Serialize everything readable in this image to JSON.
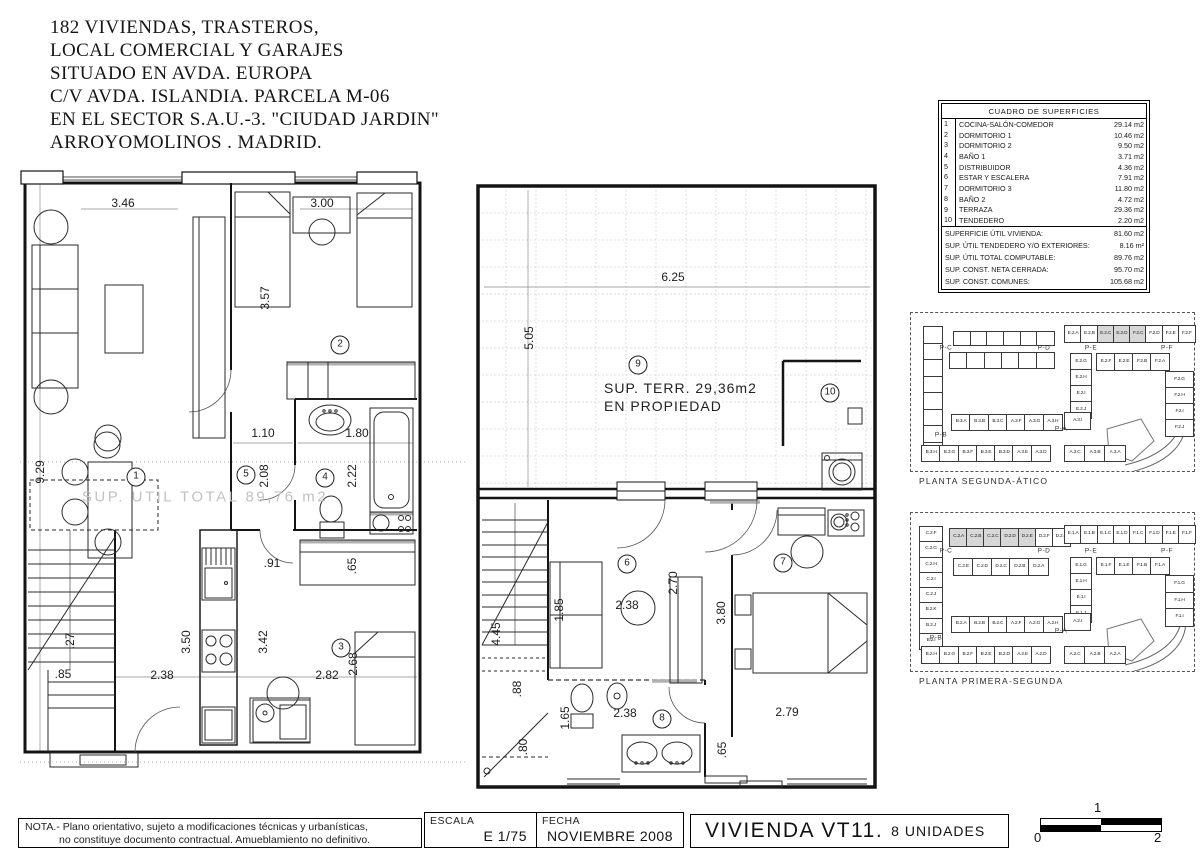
{
  "header": {
    "lines": [
      "182 VIVIENDAS, TRASTEROS,",
      "LOCAL COMERCIAL Y GARAJES",
      "SITUADO EN AVDA. EUROPA",
      "C/V  AVDA.  ISLANDIA. PARCELA M-06",
      "EN EL SECTOR S.A.U.-3. \"CIUDAD JARDIN\"",
      "ARROYOMOLINOS . MADRID."
    ]
  },
  "surface_table": {
    "title": "CUADRO DE SUPERFICIES",
    "rows": [
      {
        "num": "1",
        "name": "COCINA-SALÓN-COMEDOR",
        "area": "29.14 m2"
      },
      {
        "num": "2",
        "name": "DORMITORIO 1",
        "area": "10.46 m2"
      },
      {
        "num": "3",
        "name": "DORMITORIO 2",
        "area": "9.50 m2"
      },
      {
        "num": "4",
        "name": "BAÑO 1",
        "area": "3.71 m2"
      },
      {
        "num": "5",
        "name": "DISTRIBUIDOR",
        "area": "4.36 m2"
      },
      {
        "num": "6",
        "name": "ESTAR Y ESCALERA",
        "area": "7.91 m2"
      },
      {
        "num": "7",
        "name": "DORMITORIO 3",
        "area": "11.80 m2"
      },
      {
        "num": "8",
        "name": "BAÑO 2",
        "area": "4.72 m2"
      },
      {
        "num": "9",
        "name": "TERRAZA",
        "area": "29.36 m2"
      },
      {
        "num": "10",
        "name": "TENDEDERO",
        "area": "2.20 m2"
      }
    ],
    "summary": [
      {
        "label": "SUPERFICIE ÚTIL VIVIENDA:",
        "area": "81.60 m2"
      },
      {
        "label": "SUP. ÚTIL TENDEDERO Y/O EXTERIORES:",
        "area": "8.16 m²"
      },
      {
        "label": "SUP. ÚTIL TOTAL COMPUTABLE:",
        "area": "89.76 m2"
      },
      {
        "label": "SUP. CONST. NETA CERRADA:",
        "area": "95.70 m2"
      },
      {
        "label": "SUP. CONST. COMUNES:",
        "area": "105.68 m2"
      }
    ]
  },
  "plan_left": {
    "labels": [
      {
        "t": "3.46",
        "x": 123,
        "y": 203
      },
      {
        "t": "3.00",
        "x": 322,
        "y": 203
      },
      {
        "t": "3.57",
        "x": 265,
        "y": 298,
        "r": 1
      },
      {
        "t": "9.29",
        "x": 40,
        "y": 472,
        "r": 1
      },
      {
        "t": "1.10",
        "x": 263,
        "y": 433
      },
      {
        "t": "1.80",
        "x": 357,
        "y": 433
      },
      {
        "t": "2.08",
        "x": 264,
        "y": 476,
        "r": 1
      },
      {
        "t": "2.22",
        "x": 352,
        "y": 476,
        "r": 1
      },
      {
        "t": ".91",
        "x": 272,
        "y": 563
      },
      {
        "t": ".65",
        "x": 352,
        "y": 566,
        "r": 1
      },
      {
        "t": "3.50",
        "x": 186,
        "y": 642,
        "r": 1
      },
      {
        "t": "3.42",
        "x": 263,
        "y": 642,
        "r": 1
      },
      {
        "t": "2.38",
        "x": 162,
        "y": 675
      },
      {
        "t": "2.82",
        "x": 327,
        "y": 675
      },
      {
        "t": "2.68",
        "x": 353,
        "y": 664,
        "r": 1
      },
      {
        "t": ".85",
        "x": 63,
        "y": 674
      },
      {
        "t": ".27",
        "x": 70,
        "y": 641,
        "r": 1
      },
      {
        "t": "1",
        "x": 136,
        "y": 477,
        "c": "circ"
      },
      {
        "t": "2",
        "x": 340,
        "y": 345,
        "c": "circ"
      },
      {
        "t": "3",
        "x": 341,
        "y": 648,
        "c": "circ"
      },
      {
        "t": "4",
        "x": 325,
        "y": 478,
        "c": "circ"
      },
      {
        "t": "5",
        "x": 246,
        "y": 475,
        "c": "circ"
      },
      {
        "t": "SUP. UTIL TOTAL 89,76 m2",
        "x": 205,
        "y": 497,
        "c": "wm"
      }
    ]
  },
  "plan_center": {
    "labels": [
      {
        "t": "6.25",
        "x": 673,
        "y": 277
      },
      {
        "t": "5.05",
        "x": 529,
        "y": 338,
        "r": 1
      },
      {
        "t": "SUP. TERR. 29,36m2",
        "x": 604,
        "y": 388,
        "c": "terr"
      },
      {
        "t": "EN PROPIEDAD",
        "x": 604,
        "y": 406,
        "c": "terr"
      },
      {
        "t": "9",
        "x": 638,
        "y": 365,
        "c": "circ"
      },
      {
        "t": "10",
        "x": 830,
        "y": 393,
        "c": "circ"
      },
      {
        "t": "6",
        "x": 627,
        "y": 564,
        "c": "circ"
      },
      {
        "t": "7",
        "x": 783,
        "y": 563,
        "c": "circ"
      },
      {
        "t": "8",
        "x": 662,
        "y": 719,
        "c": "circ"
      },
      {
        "t": "4.45",
        "x": 496,
        "y": 634,
        "r": 1
      },
      {
        "t": "1.85",
        "x": 559,
        "y": 610,
        "r": 1
      },
      {
        "t": "2.38",
        "x": 627,
        "y": 605
      },
      {
        "t": "2.70",
        "x": 673,
        "y": 583,
        "r": 1
      },
      {
        "t": "3.80",
        "x": 721,
        "y": 613,
        "r": 1
      },
      {
        "t": "2.79",
        "x": 787,
        "y": 712
      },
      {
        "t": "1.65",
        "x": 565,
        "y": 718,
        "r": 1
      },
      {
        "t": "2.38",
        "x": 625,
        "y": 713
      },
      {
        "t": ".80",
        "x": 523,
        "y": 747,
        "r": 1
      },
      {
        "t": ".65",
        "x": 722,
        "y": 750,
        "r": 1
      },
      {
        "t": ".88",
        "x": 517,
        "y": 689,
        "r": 1
      }
    ]
  },
  "miniplans": [
    {
      "caption": "PLANTA SEGUNDA-ÁTICO",
      "x": 910,
      "y": 312,
      "w": 283,
      "h": 158,
      "plabels": [
        {
          "t": "P-C",
          "x": 945,
          "y": 347
        },
        {
          "t": "P-D",
          "x": 1043,
          "y": 347
        },
        {
          "t": "P-E",
          "x": 1090,
          "y": 347
        },
        {
          "t": "P-F",
          "x": 1166,
          "y": 347
        },
        {
          "t": "P-B",
          "x": 940,
          "y": 434
        },
        {
          "t": "P-A",
          "x": 1060,
          "y": 428
        }
      ],
      "groups": [
        {
          "x": 922,
          "y": 325,
          "w": 18,
          "h": 132,
          "dir": "v",
          "cells": [
            "",
            "",
            "",
            "",
            "",
            "",
            "",
            ""
          ]
        },
        {
          "x": 952,
          "y": 330,
          "w": 100,
          "h": 13,
          "dir": "h",
          "cells": [
            "",
            "",
            "",
            "",
            "",
            ""
          ]
        },
        {
          "x": 948,
          "y": 351,
          "w": 104,
          "h": 15,
          "dir": "h",
          "cells": [
            "",
            "",
            "",
            "",
            "",
            ""
          ]
        },
        {
          "x": 1063,
          "y": 324,
          "w": 130,
          "h": 16,
          "dir": "h",
          "cells": [
            "E.2.A",
            "E.2.B",
            "E.2.C",
            "E.2.D",
            "F.2.C",
            "F.2.D",
            "F.2.E",
            "F.2.F"
          ],
          "shaded": [
            2,
            3,
            4
          ]
        },
        {
          "x": 1095,
          "y": 352,
          "w": 72,
          "h": 16,
          "dir": "h",
          "cells": [
            "E.2.F",
            "E.2.E",
            "F.2.B",
            "F.2.A"
          ]
        },
        {
          "x": 1069,
          "y": 352,
          "w": 20,
          "h": 64,
          "dir": "v",
          "cells": [
            "E.2.G",
            "E.2.H",
            "E.2.I",
            "E.2.J"
          ]
        },
        {
          "x": 1164,
          "y": 370,
          "w": 27,
          "h": 64,
          "dir": "v",
          "cells": [
            "F.2.G",
            "F.2.H",
            "F.2.I",
            "F.2.J"
          ]
        },
        {
          "x": 950,
          "y": 413,
          "w": 110,
          "h": 15,
          "dir": "h",
          "cells": [
            "B.3.A",
            "B.3.B",
            "B.3.C",
            "A.3.F",
            "A.3.G",
            "A.3.H"
          ]
        },
        {
          "x": 1063,
          "y": 411,
          "w": 25,
          "h": 16,
          "dir": "h",
          "cells": [
            "A.3.I"
          ]
        },
        {
          "x": 920,
          "y": 444,
          "w": 128,
          "h": 15,
          "dir": "h",
          "cells": [
            "B.3.H",
            "B.3.G",
            "B.3.F",
            "B.3.E",
            "B.3.D",
            "A.3.E",
            "A.3.D"
          ]
        },
        {
          "x": 1063,
          "y": 444,
          "w": 60,
          "h": 15,
          "dir": "h",
          "cells": [
            "A.3.C",
            "A.3.B",
            "A.3.A"
          ]
        }
      ]
    },
    {
      "caption": "PLANTA PRIMERA-SEGUNDA",
      "x": 910,
      "y": 512,
      "w": 283,
      "h": 158,
      "plabels": [
        {
          "t": "P-C",
          "x": 945,
          "y": 550
        },
        {
          "t": "P-D",
          "x": 1043,
          "y": 550
        },
        {
          "t": "P-E",
          "x": 1090,
          "y": 550
        },
        {
          "t": "P-F",
          "x": 1166,
          "y": 550
        },
        {
          "t": "P-B",
          "x": 935,
          "y": 637
        },
        {
          "t": "P-A",
          "x": 1060,
          "y": 630
        }
      ],
      "groups": [
        {
          "x": 918,
          "y": 525,
          "w": 22,
          "h": 122,
          "dir": "v",
          "cells": [
            "C.2.F",
            "C.2.G",
            "C.2.H",
            "C.2.I",
            "C.2.J",
            "B.2.K",
            "B.2.J",
            "B.2.I"
          ]
        },
        {
          "x": 948,
          "y": 527,
          "w": 120,
          "h": 17,
          "dir": "h",
          "cells": [
            "C.2.A",
            "C.2.B",
            "C.2.C",
            "D.2.D",
            "D.2.E",
            "D.2.F",
            "D.2.G"
          ],
          "shaded": [
            0,
            1,
            2,
            3,
            4
          ]
        },
        {
          "x": 952,
          "y": 557,
          "w": 94,
          "h": 16,
          "dir": "h",
          "cells": [
            "C.2.E",
            "C.2.D",
            "D.2.C",
            "D.2.B",
            "D.2.A"
          ]
        },
        {
          "x": 1063,
          "y": 524,
          "w": 130,
          "h": 17,
          "dir": "h",
          "cells": [
            "E.1.A",
            "E.1.B",
            "E.1.C",
            "E.1.D",
            "F.1.C",
            "F.1.D",
            "F.1.E",
            "F.1.F"
          ]
        },
        {
          "x": 1095,
          "y": 556,
          "w": 72,
          "h": 16,
          "dir": "h",
          "cells": [
            "E.1.F",
            "E.1.E",
            "F.1.B",
            "F.1.A"
          ]
        },
        {
          "x": 1069,
          "y": 556,
          "w": 20,
          "h": 64,
          "dir": "v",
          "cells": [
            "E.1.G",
            "E.1.H",
            "E.1.I",
            "E.1.J"
          ]
        },
        {
          "x": 1164,
          "y": 574,
          "w": 27,
          "h": 50,
          "dir": "v",
          "cells": [
            "F.1.G",
            "F.1.H",
            "F.1.I"
          ]
        },
        {
          "x": 950,
          "y": 615,
          "w": 110,
          "h": 15,
          "dir": "h",
          "cells": [
            "B.2.A",
            "B.2.B",
            "B.2.C",
            "A.2.F",
            "A.2.G",
            "A.2.H"
          ]
        },
        {
          "x": 1063,
          "y": 612,
          "w": 25,
          "h": 16,
          "dir": "h",
          "cells": [
            "A.2.I"
          ]
        },
        {
          "x": 920,
          "y": 645,
          "w": 128,
          "h": 16,
          "dir": "h",
          "cells": [
            "B.2.H",
            "B.2.G",
            "B.2.F",
            "B.2.E",
            "B.2.D",
            "A.2.E",
            "A.2.D"
          ]
        },
        {
          "x": 1063,
          "y": 645,
          "w": 60,
          "h": 16,
          "dir": "h",
          "cells": [
            "A.2.C",
            "A.2.B",
            "A.2.A"
          ]
        }
      ]
    }
  ],
  "titlebar": {
    "nota1": "NOTA.- Plano orientativo, sujeto a modificaciones técnicas y  urbanísticas,",
    "nota2": "no constituye documento contractual. Amueblamiento no definitivo.",
    "escala_label": "ESCALA",
    "escala_value": "E 1/75",
    "fecha_label": "FECHA",
    "fecha_value": "NOVIEMBRE 2008",
    "project": "VIVIENDA VT11.",
    "units_text": "8 UNIDADES",
    "scale": {
      "t0": "0",
      "t1": "1",
      "t2": "2"
    }
  },
  "colors": {
    "line": "#1c1c1c",
    "grey_accent": "#b0b0b0",
    "shade": "#d7d7d7",
    "watermark": "#c2c2c2"
  }
}
